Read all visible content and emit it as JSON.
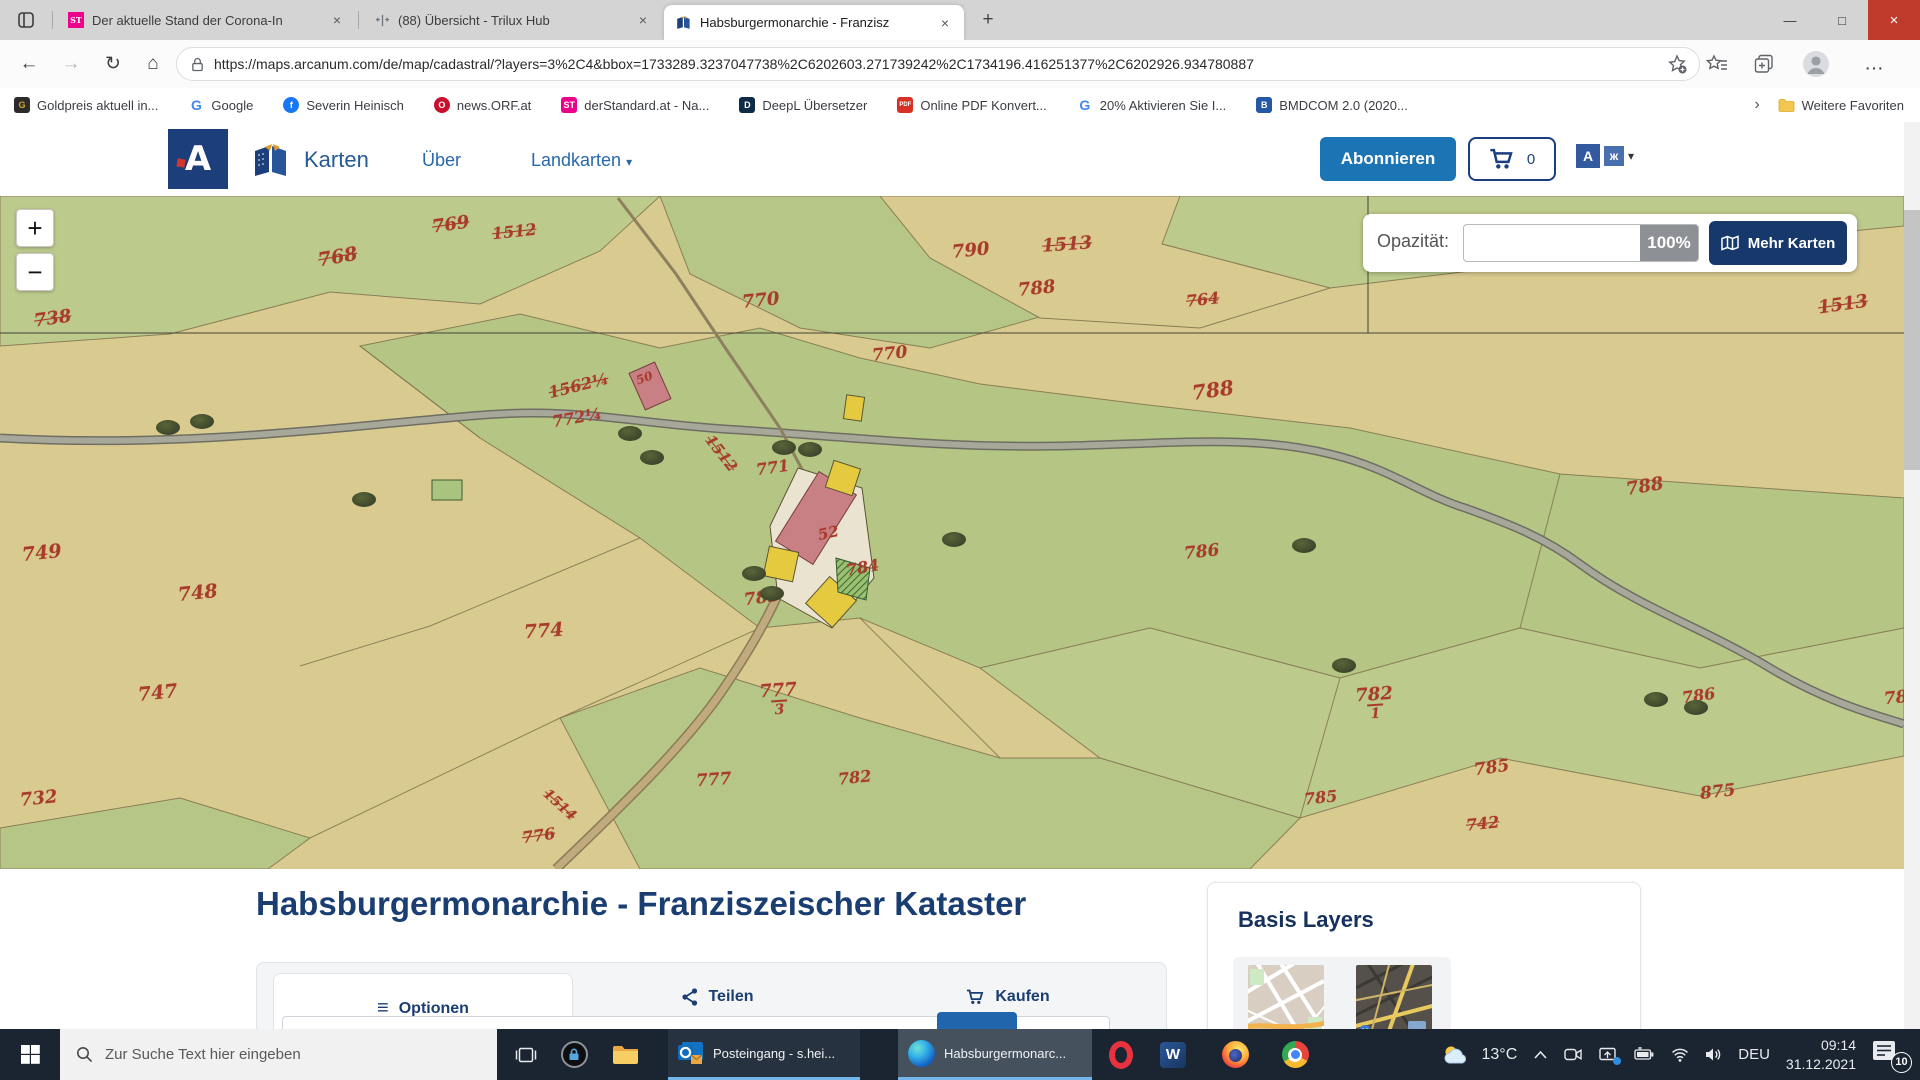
{
  "colors": {
    "brand_navy": "#16386b",
    "accent_blue": "#1b74b4",
    "parcel_red": "#a83b2c",
    "taskbar_underline": "#75b6ea",
    "derstandard_pink": "#ec008c"
  },
  "icons": {
    "back": "←",
    "forward": "→",
    "reload": "↻",
    "home": "⌂",
    "new_tab": "+",
    "close_tab": "×",
    "minimize": "—",
    "maximize": "□",
    "close_window": "×",
    "ellipsis": "…",
    "caret": "▾",
    "overflow": "›",
    "menu": "≡",
    "zoom_in": "+",
    "zoom_out": "−"
  },
  "browser": {
    "tabs": [
      {
        "title": "Der aktuelle Stand der Corona-In",
        "icon_text": "ST"
      },
      {
        "title": "(88) Übersicht - Trilux Hub",
        "icon_text": ""
      },
      {
        "title": "Habsburgermonarchie - Franzisz",
        "icon_text": ""
      }
    ],
    "url": "https://maps.arcanum.com/de/map/cadastral/?layers=3%2C4&bbox=1733289.3237047738%2C6202603.271739242%2C1734196.416251377%2C6202926.934780887",
    "bookmarks": [
      {
        "label": "Goldpreis aktuell in...",
        "icon_text": "G",
        "bg": "#2b2b2b",
        "fg": "#d9a727",
        "shape": "square"
      },
      {
        "label": "Google",
        "icon_text": "G",
        "bg": "transparent",
        "fg": "#4285f4",
        "shape": "plain"
      },
      {
        "label": "Severin Heinisch",
        "icon_text": "f",
        "bg": "#1877f2",
        "fg": "#ffffff",
        "shape": "circle"
      },
      {
        "label": "news.ORF.at",
        "icon_text": "O",
        "bg": "#c8102e",
        "fg": "#ffffff",
        "shape": "circle"
      },
      {
        "label": "derStandard.at - Na...",
        "icon_text": "ST",
        "bg": "#ec008c",
        "fg": "#ffffff",
        "shape": "square"
      },
      {
        "label": "DeepL Übersetzer",
        "icon_text": "D",
        "bg": "#0f2b46",
        "fg": "#ffffff",
        "shape": "square"
      },
      {
        "label": "Online PDF Konvert...",
        "icon_text": "PDF",
        "bg": "#d93025",
        "fg": "#ffffff",
        "shape": "square"
      },
      {
        "label": "20% Aktivieren Sie I...",
        "icon_text": "G",
        "bg": "transparent",
        "fg": "#4285f4",
        "shape": "plain"
      },
      {
        "label": "BMDCOM 2.0 (2020...",
        "icon_text": "B",
        "bg": "#2458a6",
        "fg": "#ffffff",
        "shape": "square"
      }
    ],
    "more_favorites": "Weitere Favoriten"
  },
  "site": {
    "brand_label": "Karten",
    "nav_about": "Über",
    "nav_maps": "Landkarten",
    "subscribe_label": "Abonnieren",
    "cart_count": "0",
    "lang_letter": "A",
    "lang_letter2": "ж"
  },
  "map": {
    "opacity_label": "Opazität:",
    "opacity_value": "100%",
    "more_maps_label": "Mehr Karten",
    "building_label": "50",
    "parcels": [
      {
        "t": "738",
        "x": 34,
        "y": 114,
        "s": 18,
        "r": -8,
        "struck": true
      },
      {
        "t": "768",
        "x": 318,
        "y": 52,
        "s": 19,
        "r": -10,
        "struck": true
      },
      {
        "t": "769",
        "x": 432,
        "y": 20,
        "s": 18,
        "r": -8,
        "struck": true
      },
      {
        "t": "1512",
        "x": 492,
        "y": 28,
        "s": 16,
        "r": -6,
        "struck": true
      },
      {
        "t": "770",
        "x": 742,
        "y": 96,
        "s": 18,
        "r": -6
      },
      {
        "t": "790",
        "x": 952,
        "y": 46,
        "s": 18,
        "r": -6
      },
      {
        "t": "1513",
        "x": 1042,
        "y": 40,
        "s": 18,
        "r": -4,
        "struck": true
      },
      {
        "t": "788",
        "x": 1018,
        "y": 84,
        "s": 18,
        "r": -6
      },
      {
        "t": "764",
        "x": 1186,
        "y": 96,
        "s": 16,
        "r": -6,
        "struck": true
      },
      {
        "t": "1513",
        "x": 1818,
        "y": 100,
        "s": 18,
        "r": -8,
        "struck": true
      },
      {
        "t": "770",
        "x": 872,
        "y": 150,
        "s": 17,
        "r": -6
      },
      {
        "t": "788",
        "x": 1192,
        "y": 184,
        "s": 20,
        "r": -8
      },
      {
        "t": "1562¼",
        "x": 548,
        "y": 182,
        "s": 16,
        "r": -14,
        "struck": true
      },
      {
        "t": "772¼",
        "x": 552,
        "y": 214,
        "s": 16,
        "r": -10
      },
      {
        "t": "50",
        "x": 636,
        "y": 176,
        "s": 12,
        "r": -20
      },
      {
        "t": "771",
        "x": 756,
        "y": 264,
        "s": 16,
        "r": -8
      },
      {
        "t": "1512",
        "x": 700,
        "y": 250,
        "s": 15,
        "r": 52,
        "struck": true
      },
      {
        "t": "52",
        "x": 818,
        "y": 330,
        "s": 15,
        "r": -12
      },
      {
        "t": "784",
        "x": 846,
        "y": 364,
        "s": 16,
        "r": -10
      },
      {
        "t": "783",
        "x": 744,
        "y": 394,
        "s": 17,
        "r": -8
      },
      {
        "t": "774",
        "x": 524,
        "y": 426,
        "s": 19,
        "r": -4
      },
      {
        "t": "749",
        "x": 22,
        "y": 348,
        "s": 19,
        "r": -6
      },
      {
        "t": "748",
        "x": 178,
        "y": 388,
        "s": 19,
        "r": -6
      },
      {
        "t": "747",
        "x": 138,
        "y": 488,
        "s": 19,
        "r": -6
      },
      {
        "t": "732",
        "x": 20,
        "y": 594,
        "s": 18,
        "r": -6
      },
      {
        "t": "777",
        "x": 760,
        "y": 486,
        "s": 18,
        "r": -4,
        "den": "3"
      },
      {
        "t": "782",
        "x": 1356,
        "y": 490,
        "s": 18,
        "r": -4,
        "den": "1"
      },
      {
        "t": "786",
        "x": 1184,
        "y": 348,
        "s": 17,
        "r": -6
      },
      {
        "t": "788",
        "x": 1626,
        "y": 282,
        "s": 18,
        "r": -10
      },
      {
        "t": "785",
        "x": 1474,
        "y": 564,
        "s": 17,
        "r": -8
      },
      {
        "t": "785",
        "x": 1304,
        "y": 594,
        "s": 16,
        "r": -6
      },
      {
        "t": "875",
        "x": 1700,
        "y": 588,
        "s": 17,
        "r": -6
      },
      {
        "t": "786",
        "x": 1682,
        "y": 492,
        "s": 16,
        "r": -8
      },
      {
        "t": "78",
        "x": 1884,
        "y": 494,
        "s": 17,
        "r": -6
      },
      {
        "t": "742",
        "x": 1466,
        "y": 620,
        "s": 16,
        "r": -6,
        "struck": true
      },
      {
        "t": "776",
        "x": 522,
        "y": 632,
        "s": 16,
        "r": -8,
        "struck": true
      },
      {
        "t": "1514",
        "x": 540,
        "y": 602,
        "s": 14,
        "r": 42,
        "struck": true
      },
      {
        "t": "777",
        "x": 696,
        "y": 576,
        "s": 17,
        "r": -4
      },
      {
        "t": "782",
        "x": 838,
        "y": 574,
        "s": 16,
        "r": -6
      }
    ],
    "trees": [
      [
        190,
        218
      ],
      [
        156,
        224
      ],
      [
        618,
        230
      ],
      [
        640,
        254
      ],
      [
        772,
        244
      ],
      [
        798,
        246
      ],
      [
        942,
        336
      ],
      [
        1292,
        342
      ],
      [
        1332,
        462
      ],
      [
        1644,
        496
      ],
      [
        1684,
        504
      ],
      [
        742,
        370
      ],
      [
        760,
        390
      ],
      [
        352,
        296
      ]
    ]
  },
  "panel": {
    "title": "Habsburgermonarchie - Franziszeischer Kataster",
    "tabs": [
      {
        "label": "Optionen"
      },
      {
        "label": "Teilen"
      },
      {
        "label": "Kaufen"
      }
    ],
    "basis_layers_title": "Basis Layers"
  },
  "taskbar": {
    "search_placeholder": "Zur Suche Text hier eingeben",
    "windows": [
      {
        "label": "Posteingang - s.hei..."
      },
      {
        "label": "Habsburgermonarc..."
      }
    ],
    "weather_temp": "13°C",
    "language": "DEU",
    "time": "09:14",
    "date": "31.12.2021",
    "notification_count": "10"
  }
}
